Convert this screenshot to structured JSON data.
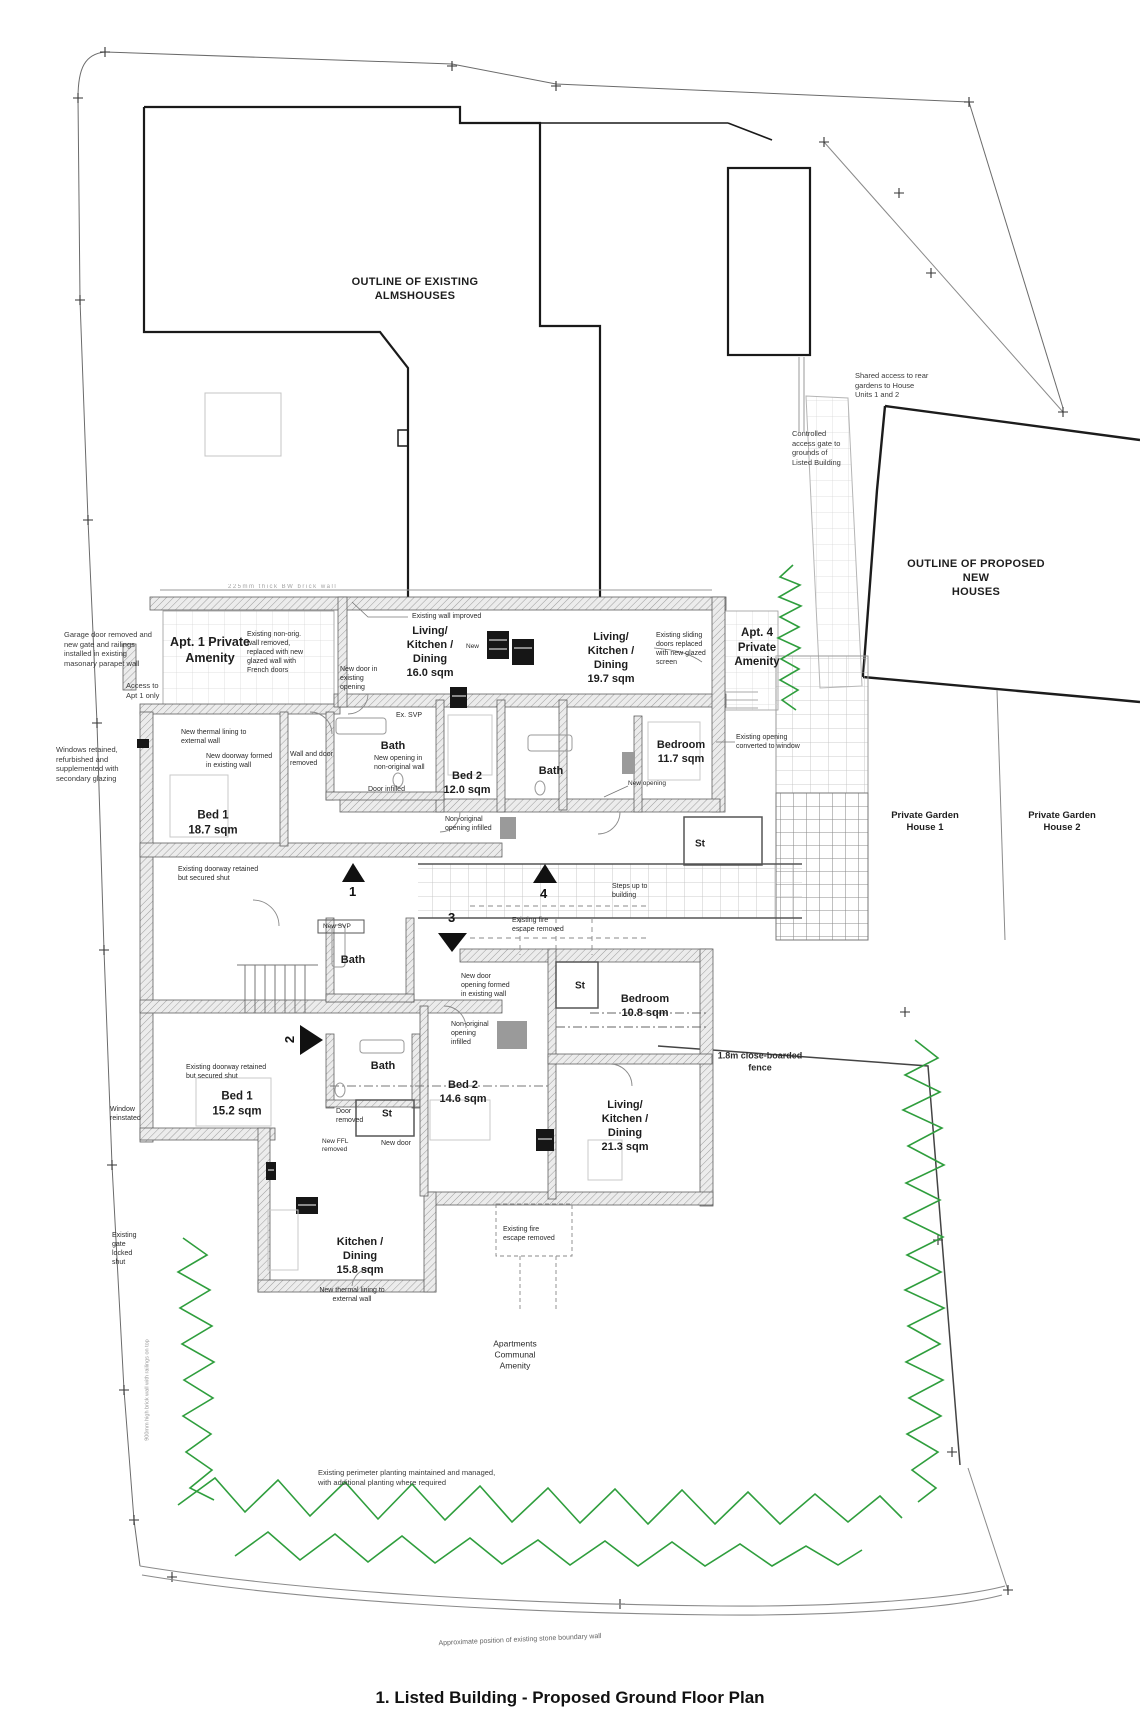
{
  "title": "1. Listed Building - Proposed Ground Floor Plan",
  "colors": {
    "planting_green": "#2f9e3d",
    "wall_gray": "#9d9d9d",
    "line_dark": "#1a1a1a"
  },
  "site": {
    "almshouses": "OUTLINE OF EXISTING\nALMSHOUSES",
    "new_houses": "OUTLINE OF PROPOSED NEW\nHOUSES",
    "garden1": "Private Garden\nHouse 1",
    "garden2": "Private Garden\nHouse 2",
    "shared_access": "Shared access to rear\ngardens to House\nUnits 1 and 2",
    "controlled_gate": "Controlled\naccess gate to\ngrounds of\nListed Building",
    "fence": "1.8m close-boarded\nfence",
    "communal": "Apartments\nCommunal\nAmenity",
    "perimeter": "Existing perimeter planting maintained and managed,\nwith additional planting where required",
    "boundary_wall": "Approximate position of existing stone boundary wall",
    "left_wall_note": "900mm high brick wall with railings on top",
    "gate_locked": "Existing\ngate\nlocked\nshut",
    "wall_dim": "225mm thick BW brick wall"
  },
  "apartments": {
    "apt1": "Apt. 1 Private\nAmenity",
    "apt4": "Apt. 4\nPrivate\nAmenity"
  },
  "rooms": {
    "lkd16": {
      "name": "Living/\nKitchen /\nDining",
      "area": "16.0 sqm"
    },
    "lkd197": {
      "name": "Living/\nKitchen /\nDining",
      "area": "19.7 sqm"
    },
    "lkd213": {
      "name": "Living/\nKitchen /\nDining",
      "area": "21.3 sqm"
    },
    "kd158": {
      "name": "Kitchen /\nDining",
      "area": "15.8 sqm"
    },
    "bed2_12": {
      "name": "Bed 2",
      "area": "12.0 sqm"
    },
    "bed1_187": {
      "name": "Bed 1",
      "area": "18.7 sqm"
    },
    "bed1_152": {
      "name": "Bed 1",
      "area": "15.2 sqm"
    },
    "bed2_146": {
      "name": "Bed 2",
      "area": "14.6 sqm"
    },
    "bedroom117": {
      "name": "Bedroom",
      "area": "11.7 sqm"
    },
    "bedroom108": {
      "name": "Bedroom",
      "area": "10.8 sqm"
    },
    "bath1": "Bath",
    "bath2": "Bath",
    "bath3": "Bath",
    "bath4": "Bath",
    "st1": "St",
    "st2": "St",
    "st3": "St"
  },
  "notes": {
    "garage": "Garage door removed and\nnew gate and railings\ninstalled in existing\nmasonary parapet wall",
    "access_apt1": "Access to\nApt 1 only",
    "windows_retained": "Windows retained,\nrefurbished and\nsupplemented with\nsecondary glazing",
    "non_orig_removed": "Existing non-orig.\nwall removed,\nreplaced with new\nglazed wall with\nFrench doors",
    "new_door_existing": "New door in\nexisting\nopening",
    "wall_improved": "Existing wall improved",
    "new_small": "New",
    "ex_svp": "Ex. SVP",
    "new_opening_nonorig": "New opening in\nnon-original wall",
    "door_infilled": "Door infilled",
    "sliding": "Existing sliding\ndoors replaced\nwith new glazed\nscreen",
    "opening_window": "Existing opening\nconverted to window",
    "new_opening": "New opening",
    "thermal_top": "New thermal lining to\nexternal wall",
    "doorway_formed_top": "New doorway formed\nin existing wall",
    "wall_door_removed": "Wall and door\nremoved",
    "doorway_retained_top": "Existing doorway retained\nbut secured shut",
    "nonorig_infilled_1": "Non-original\nopening infilled",
    "steps_up": "Steps up to\nbuilding",
    "fire_escape_1": "Existing fire\nescape removed",
    "new_svp": "New SVP",
    "new_door_opening": "New door\nopening formed\nin existing wall",
    "nonorig_infilled_2": "Non-original\nopening\ninfilled",
    "doorway_retained_low": "Existing doorway retained\nbut secured shut",
    "window_reinstated": "Window\nreinstated",
    "door_removed": "Door\nremoved",
    "ffl_removed": "New FFL\nremoved",
    "new_door": "New door",
    "fire_escape_2": "Existing fire\nescape removed",
    "thermal_low": "New thermal lining to\nexternal wall"
  },
  "markers": {
    "m1": "1",
    "m2": "2",
    "m3": "3",
    "m4": "4"
  }
}
